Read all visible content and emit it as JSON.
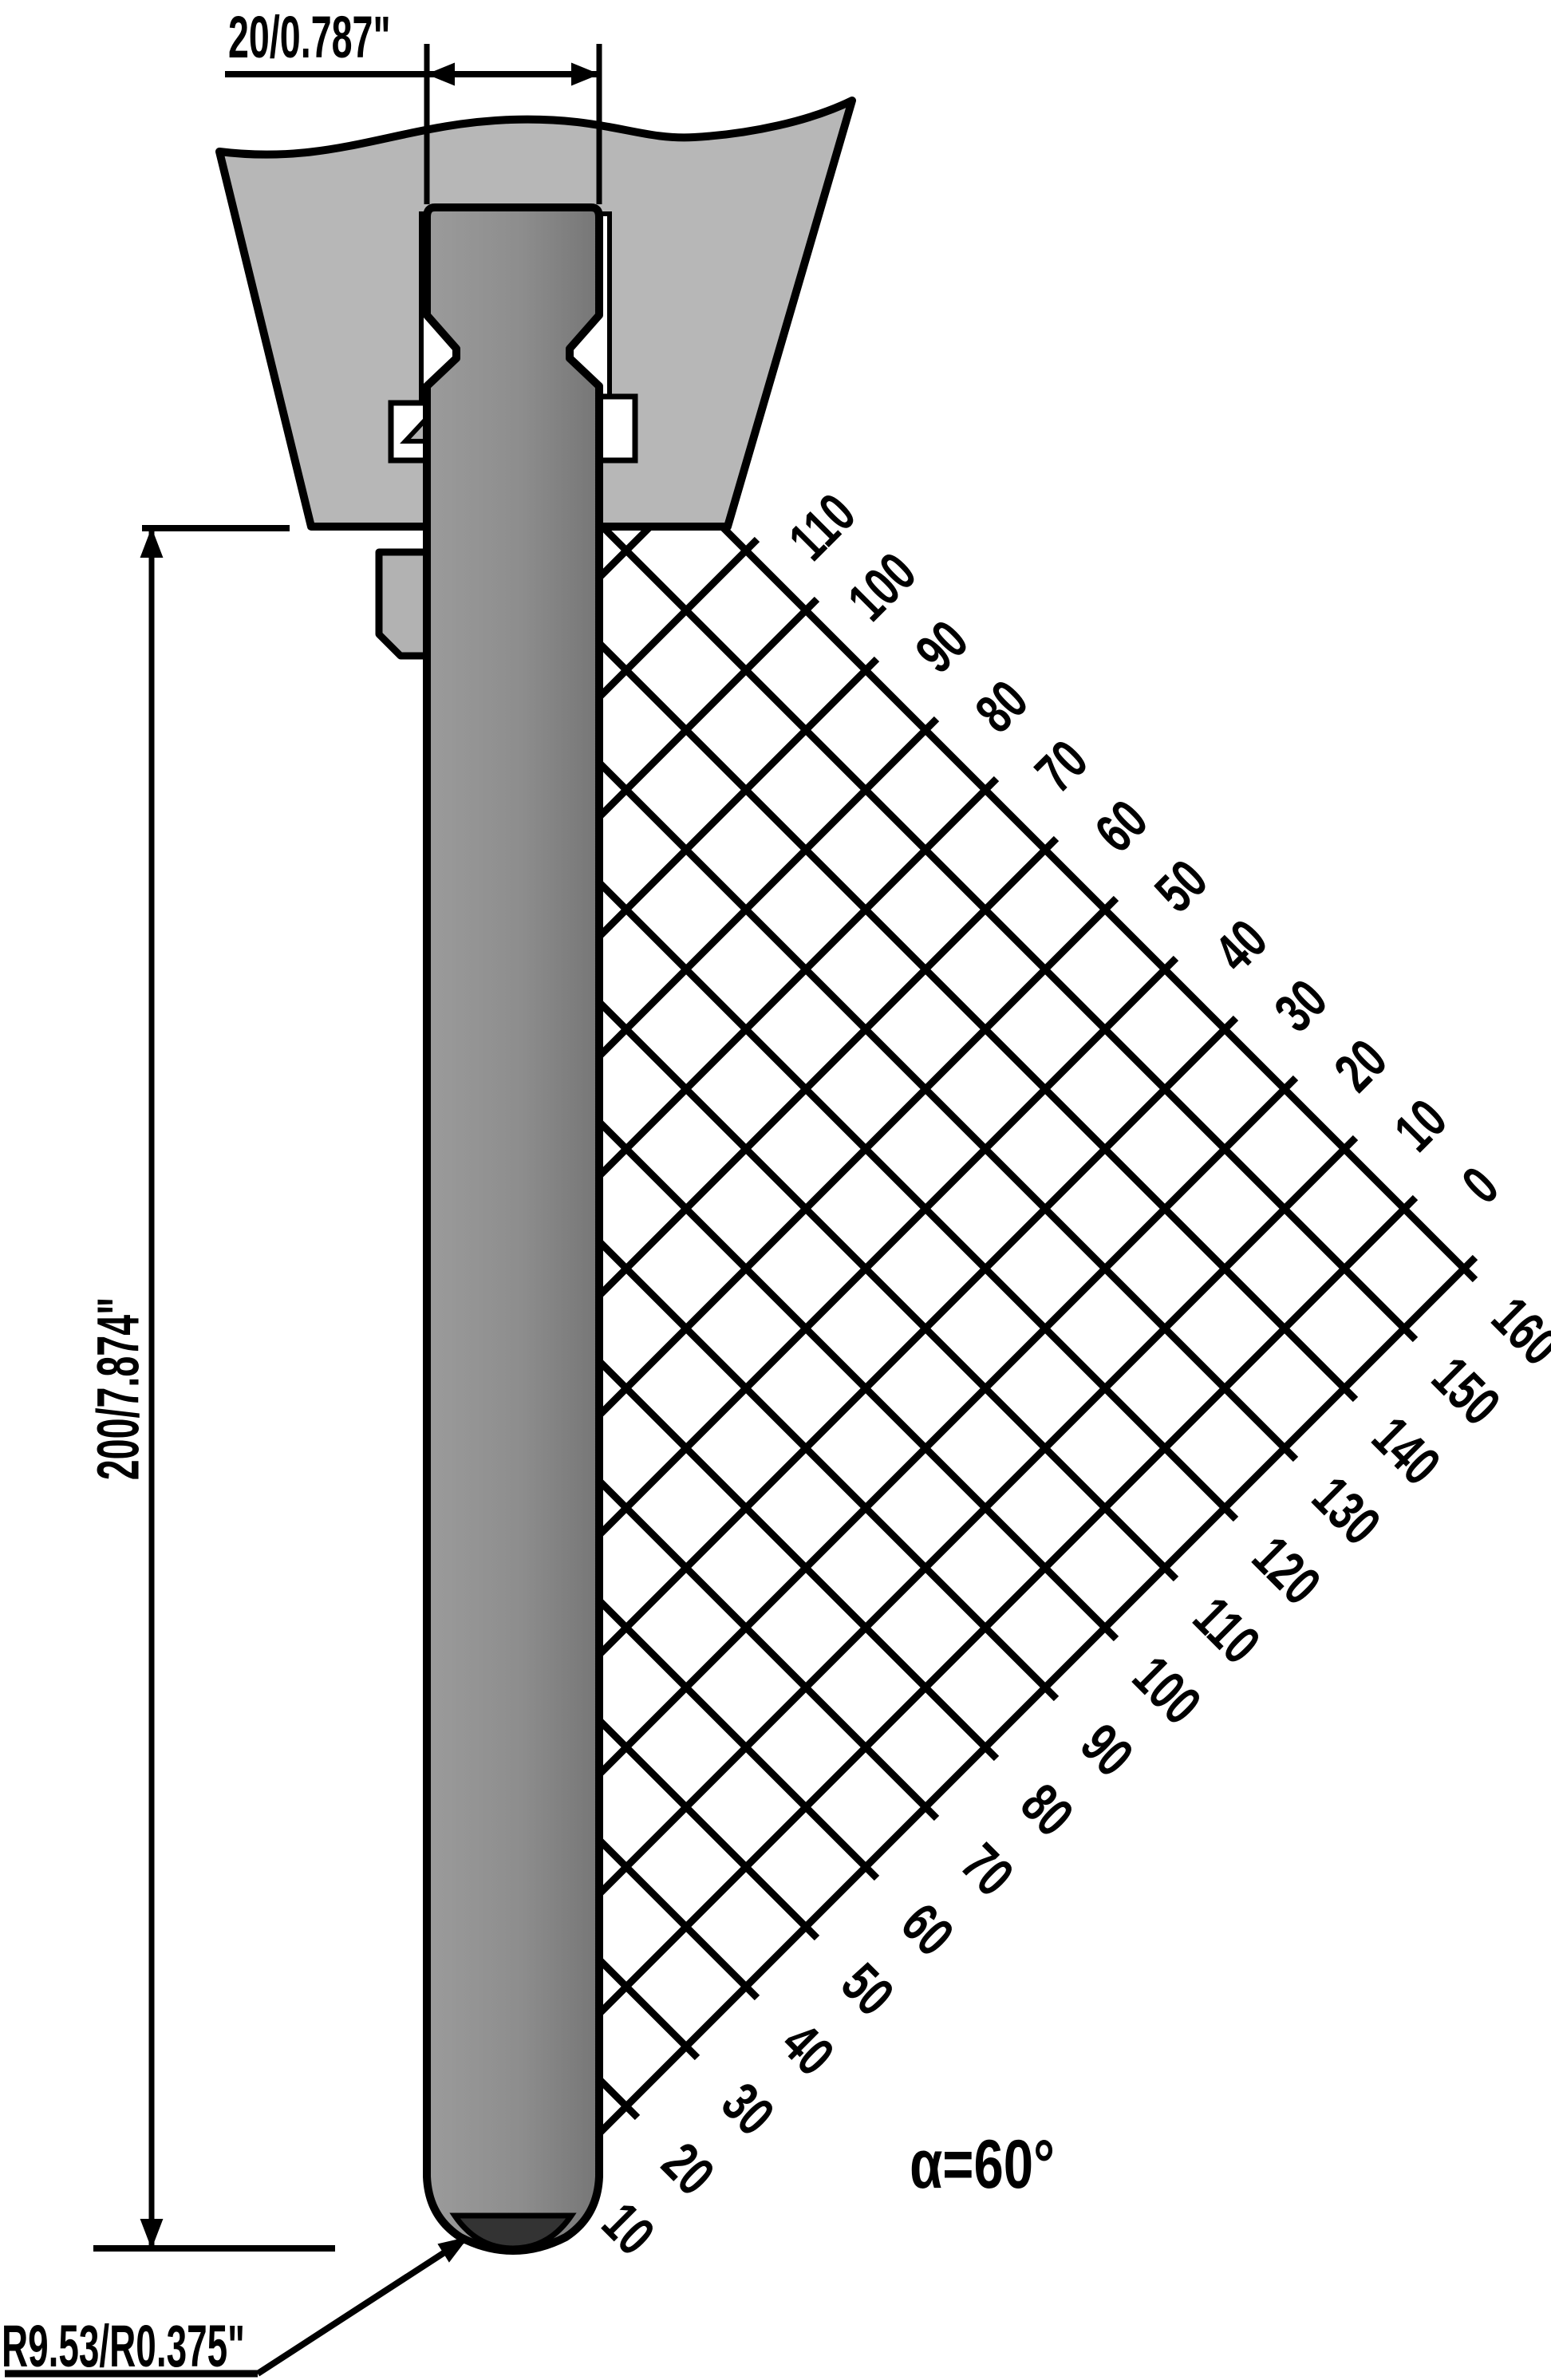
{
  "drawing": {
    "type": "press-brake punch tool profile",
    "dimensions": {
      "width_label": "20/0.787\"",
      "height_label": "200/7.874\"",
      "radius_label": "R9.53/R0.375\"",
      "angle_label": "α=60°"
    },
    "grid": {
      "top_labels": [
        "110",
        "100",
        "90",
        "80",
        "70",
        "60",
        "50",
        "40",
        "30",
        "20",
        "10",
        "0"
      ],
      "right_labels": [
        "160",
        "150",
        "140",
        "130",
        "120",
        "110",
        "100",
        "90",
        "80",
        "70",
        "60",
        "50",
        "40",
        "30",
        "20",
        "10"
      ]
    },
    "colors": {
      "background": "#ffffff",
      "holder": "#b7b7b7",
      "punch_light": "#989898",
      "punch_dark": "#7a7a7a",
      "tip_cap": "#333333",
      "tab": "#b2b2b2",
      "line": "#000000"
    }
  }
}
